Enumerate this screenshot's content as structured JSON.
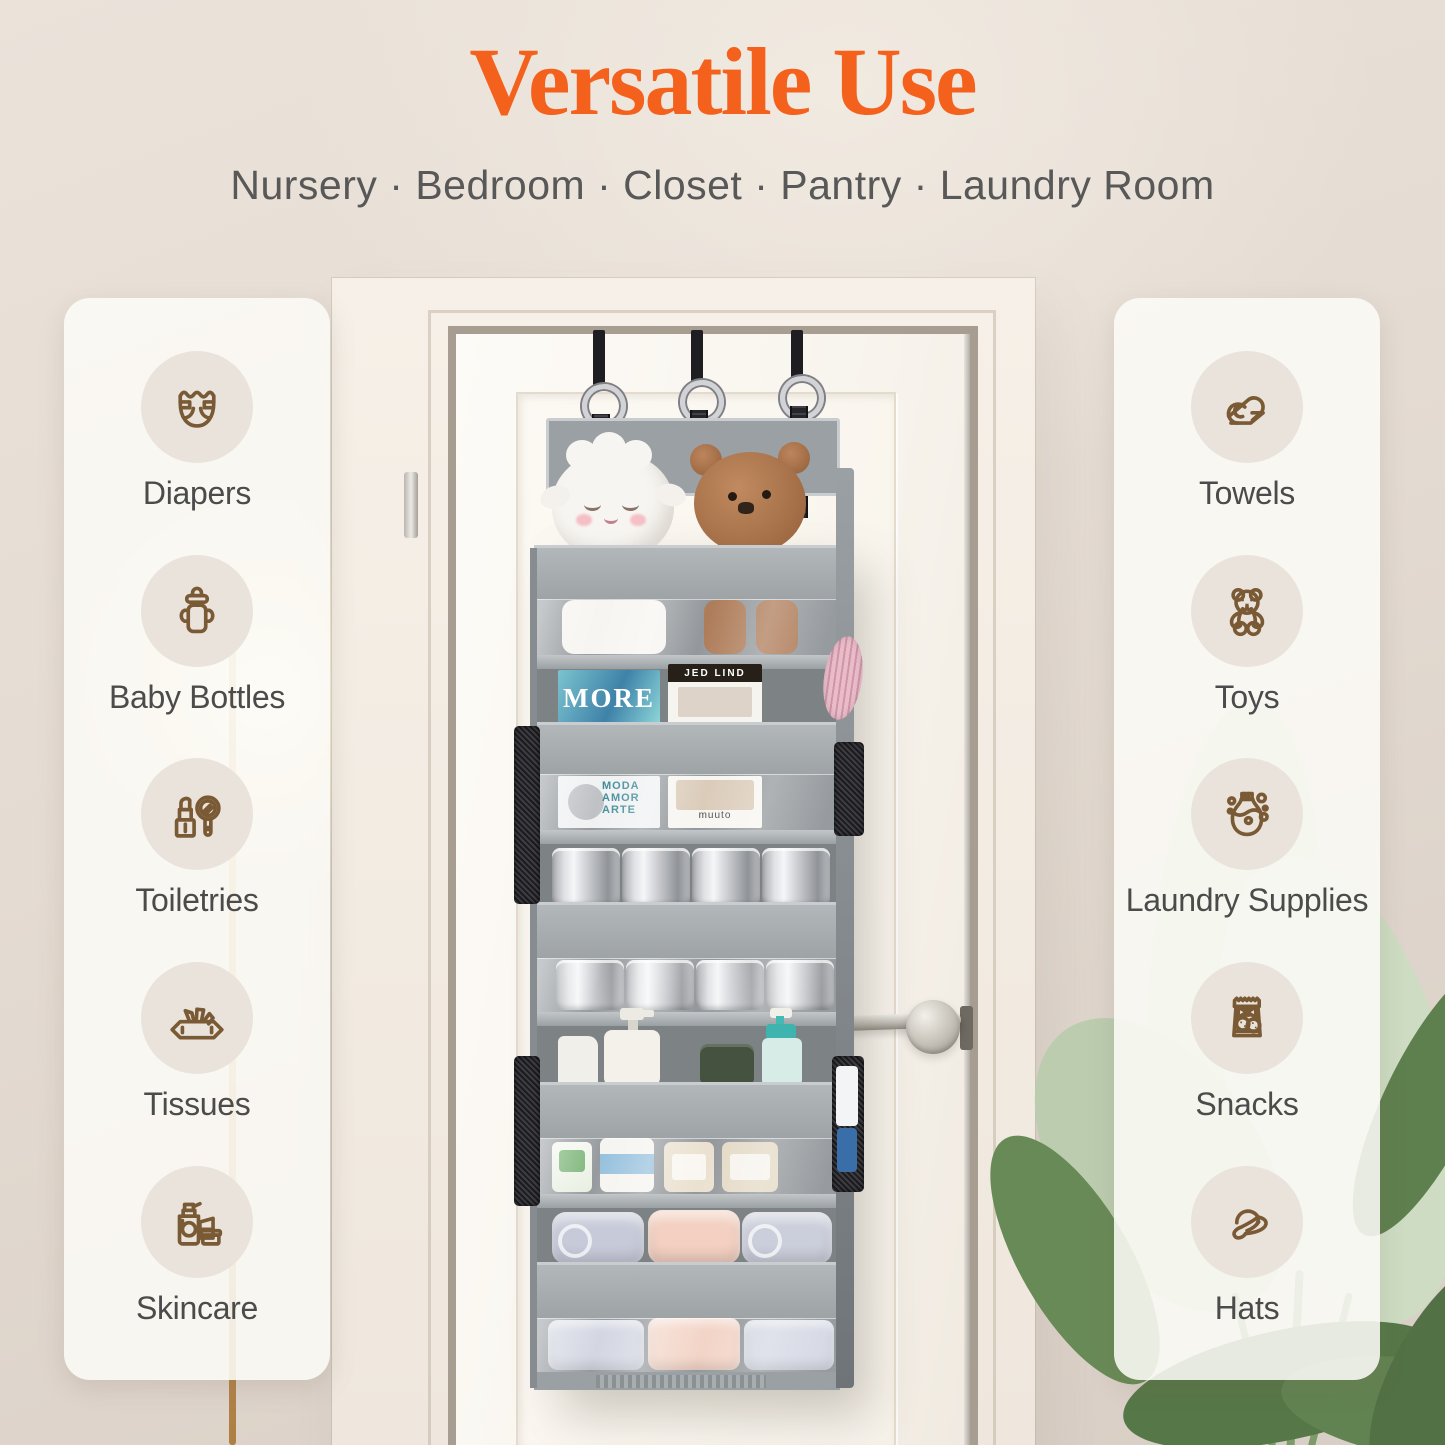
{
  "header": {
    "title": "Versatile Use",
    "subtitle": "Nursery · Bedroom · Closet · Pantry · Laundry Room",
    "title_color": "#F4611C",
    "subtitle_color": "#585858"
  },
  "panels": {
    "icon_color": "#7A5A35",
    "label_color": "#4B4B4B",
    "left": {
      "items": [
        {
          "label": "Diapers",
          "icon": "diaper-icon"
        },
        {
          "label": "Baby Bottles",
          "icon": "baby-bottle-icon"
        },
        {
          "label": "Toiletries",
          "icon": "toiletries-icon"
        },
        {
          "label": "Tissues",
          "icon": "tissues-icon"
        },
        {
          "label": "Skincare",
          "icon": "skincare-icon"
        }
      ]
    },
    "right": {
      "items": [
        {
          "label": "Towels",
          "icon": "rolled-towel-icon"
        },
        {
          "label": "Toys",
          "icon": "teddy-bear-icon"
        },
        {
          "label": "Laundry Supplies",
          "icon": "laundry-detergent-icon"
        },
        {
          "label": "Snacks",
          "icon": "snack-bag-icon"
        },
        {
          "label": "Hats",
          "icon": "sun-hat-icon"
        }
      ]
    }
  },
  "organizer": {
    "fabric_color": "#A2A7AA",
    "hook_count": 3,
    "magazine_texts": {
      "magazine_top_left": "MORE",
      "book_top_right": "JED LIND",
      "magazine_bottom_left": "MODA AMOR ARTE",
      "book_bottom_right": "muuto"
    }
  },
  "scene_colors": {
    "wall": "#E6DDD4",
    "door": "#FBF8F2",
    "plant_green": "#5E7F4E",
    "lamp_pole_gold": "#CDA26A"
  }
}
